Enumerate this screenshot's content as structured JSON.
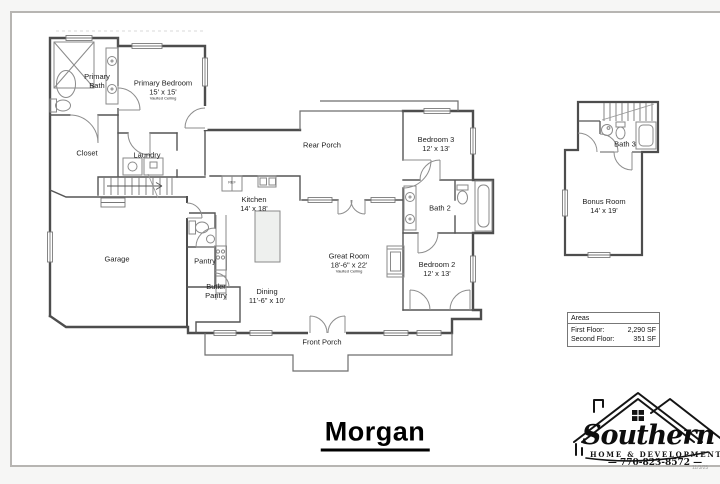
{
  "page": {
    "plan_title": "Morgan",
    "date_stamp": "11/3/25"
  },
  "first_floor": {
    "primary_bath": {
      "name": "Primary Bath"
    },
    "primary_bedroom": {
      "name": "Primary Bedroom",
      "dims": "15' x 15'",
      "note": "Vaulted Ceiling"
    },
    "closet": {
      "name": "Closet"
    },
    "laundry": {
      "name": "Laundry"
    },
    "garage": {
      "name": "Garage"
    },
    "rear_porch": {
      "name": "Rear Porch"
    },
    "kitchen": {
      "name": "Kitchen",
      "dims": "14' x 18'"
    },
    "ref_label": "REF",
    "pantry": {
      "name": "Pantry"
    },
    "butler_pantry": {
      "name": "Butler Pantry"
    },
    "dining": {
      "name": "Dining",
      "dims": "11'-6\" x 10'"
    },
    "great_room": {
      "name": "Great Room",
      "dims": "18'-6\" x 22'",
      "note": "Vaulted Ceiling"
    },
    "front_porch": {
      "name": "Front Porch"
    },
    "bedroom_3": {
      "name": "Bedroom 3",
      "dims": "12' x 13'"
    },
    "bath_2": {
      "name": "Bath 2"
    },
    "bedroom_2": {
      "name": "Bedroom 2",
      "dims": "12' x 13'"
    }
  },
  "second_floor": {
    "bonus_room": {
      "name": "Bonus Room",
      "dims": "14' x 19'"
    },
    "bath_3": {
      "name": "Bath 3"
    }
  },
  "areas": {
    "title": "Areas",
    "rows": [
      {
        "label": "First Floor:",
        "value": "2,290 SF"
      },
      {
        "label": "Second Floor:",
        "value": "351 SF"
      }
    ]
  },
  "logo": {
    "brand": "Southern Ridge",
    "tagline": "HOME & DEVELOPMENT",
    "phone": "— 770-823-8572 —"
  },
  "colors": {
    "wall": "#4d4d4d",
    "fixture": "#8a8a8a",
    "frame_border": "#b7b5b2"
  }
}
